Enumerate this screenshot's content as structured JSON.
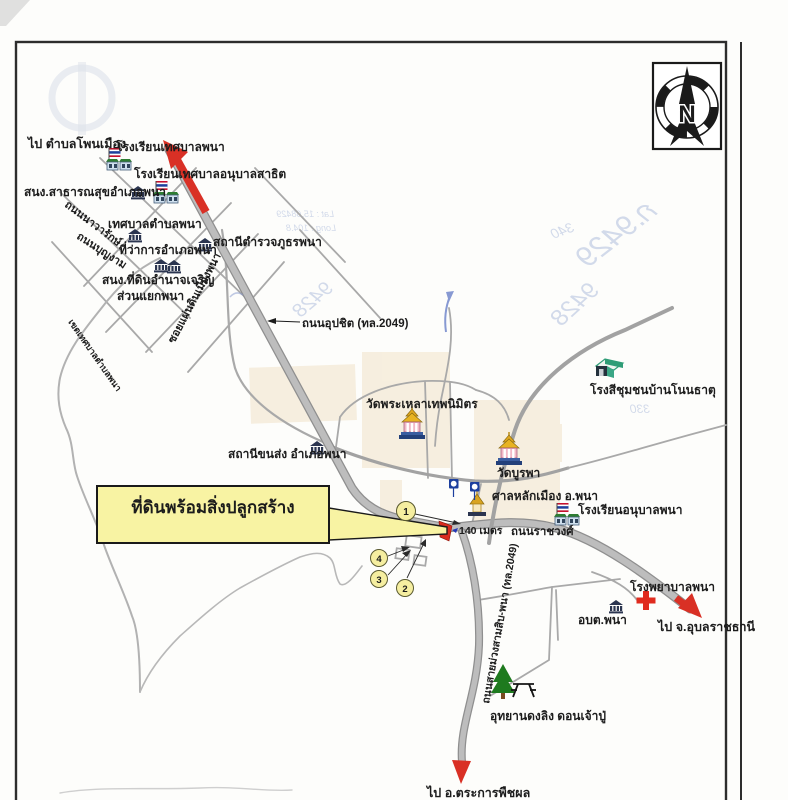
{
  "compass": {
    "letter": "N"
  },
  "callout": {
    "label": "ที่ดินพร้อมสิ่งปลูกสร้าง"
  },
  "directions": {
    "northwest": "ไป ตำบลโพนเมือง",
    "south": "ไป อ.ตระการพืชผล",
    "east": "ไป จ.อุบลราชธานี"
  },
  "roads": {
    "uppachit": "ถนนอุปชิต (ทล.2049)",
    "muang_samsip": "ถนนสายม่วงสามสิบ-พนา (ทล.2049)",
    "ratchawong": "ถนนราชวงศ์",
    "nawarak": "ถนนนาวารักษ์",
    "bunngam": "ถนนบุญงาม",
    "soi_phaendin": "ซอยแผ่นดินเมืองพนา",
    "west_boundary": "เขตเทศบาลตำบลพนา"
  },
  "places": {
    "school_thetsaban": "โรงเรียนเทศบาลพนา",
    "school_anuban_sathit": "โรงเรียนเทศบาลอนุบาลสาธิต",
    "public_health": "สนง.สาธารณสุขอำเภอพนา",
    "municipality": "เทศบาลตำบลพนา",
    "district_office": "ที่ว่าการอำเภอพนา",
    "police_station": "สถานีตำรวจภูธรพนา",
    "land_office": "สนง.ที่ดินอำนาจเจริญ",
    "phana_fork": "ส่วนแยกพนา",
    "wat_phra_lao": "วัดพระเหลาเทพนิมิตร",
    "bus_terminal": "สถานีขนส่ง อำเภอพนา",
    "wat_burapha": "วัดบูรพา",
    "city_pillar_shrine": "ศาลหลักเมือง อ.พนา",
    "school_anuban_phana": "โรงเรียนอนุบาลพนา",
    "rice_mill": "โรงสีชุมชนบ้านโนนธาตุ",
    "sao_phana": "อบต.พนา",
    "hospital": "โรงพยาบาลพนา",
    "monkey_park": "อุทยานดงลิง ดอนเจ้าปู่"
  },
  "annotations": {
    "distance": "140 เมตร",
    "markers": {
      "m1": "1",
      "m2": "2",
      "m3": "3",
      "m4": "4"
    }
  },
  "handwriting": {
    "hw1": "ก.9429",
    "hw2": "9428",
    "hw3": "340",
    "hw4": "330",
    "lat": "Lat : 15.68429",
    "long": "Long : 104.8"
  },
  "colors": {
    "callout_yellow": "#f8f3a3",
    "marker_yellow": "#f5eea0",
    "arrow_red": "#d93025",
    "parcel_red": "#d92b1f",
    "distance_blue": "#2438b8",
    "hospital_orange": "#e8681a",
    "direction_maroon": "#7a2a20",
    "road_gray": "#b3b3b3"
  }
}
